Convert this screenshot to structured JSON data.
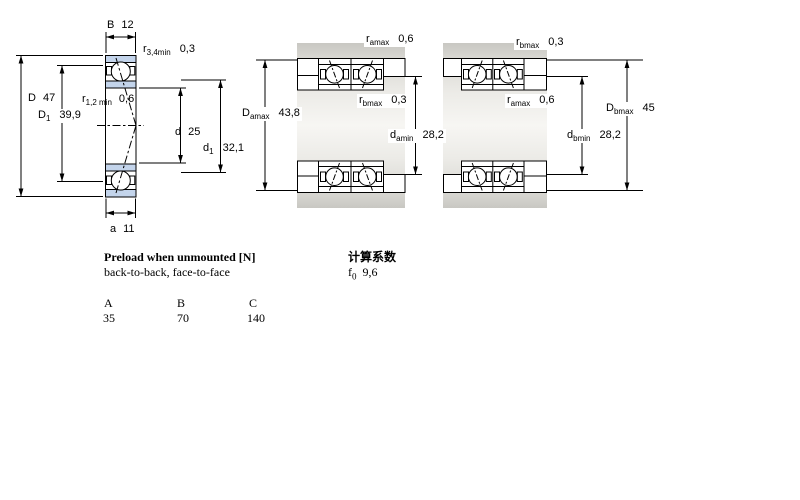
{
  "colors": {
    "bearing_blue": "#c3d4eb",
    "housing_gray_dark": "#c9c8c3",
    "housing_gray_light": "#f7f6f3",
    "line_black": "#000000"
  },
  "left_view": {
    "dims": {
      "B": {
        "base": "B",
        "value": "12"
      },
      "r34": {
        "base": "r",
        "sub": "3,4min",
        "value": "0,3"
      },
      "D": {
        "base": "D",
        "value": "47"
      },
      "D1": {
        "base": "D",
        "sub": "1",
        "value": "39,9"
      },
      "r12": {
        "base": "r",
        "sub": "1,2 min",
        "value": "0,6"
      },
      "d": {
        "base": "d",
        "value": "25"
      },
      "d1": {
        "base": "d",
        "sub": "1",
        "value": "32,1"
      },
      "a": {
        "base": "a",
        "value": "11"
      }
    }
  },
  "arrangement_left": {
    "dims": {
      "ra_top": {
        "base": "r",
        "sub": "amax",
        "value": "0,6"
      },
      "Da": {
        "base": "D",
        "sub": "amax",
        "value": "43,8"
      },
      "rb_inner": {
        "base": "r",
        "sub": "bmax",
        "value": "0,3"
      },
      "da": {
        "base": "d",
        "sub": "amin",
        "value": "28,2"
      }
    }
  },
  "arrangement_right": {
    "dims": {
      "rb_top": {
        "base": "r",
        "sub": "bmax",
        "value": "0,3"
      },
      "ra_inner": {
        "base": "r",
        "sub": "amax",
        "value": "0,6"
      },
      "Db": {
        "base": "D",
        "sub": "bmax",
        "value": "45"
      },
      "db": {
        "base": "d",
        "sub": "bmin",
        "value": "28,2"
      }
    }
  },
  "preload_table": {
    "title": "Preload when unmounted [N]",
    "subtitle": "back-to-back, face-to-face",
    "columns": [
      "A",
      "B",
      "C"
    ],
    "values": [
      "35",
      "70",
      "140"
    ]
  },
  "calculation_factors": {
    "title": "计算系数",
    "f0": {
      "base": "f",
      "sub": "0",
      "value": "9,6"
    }
  }
}
